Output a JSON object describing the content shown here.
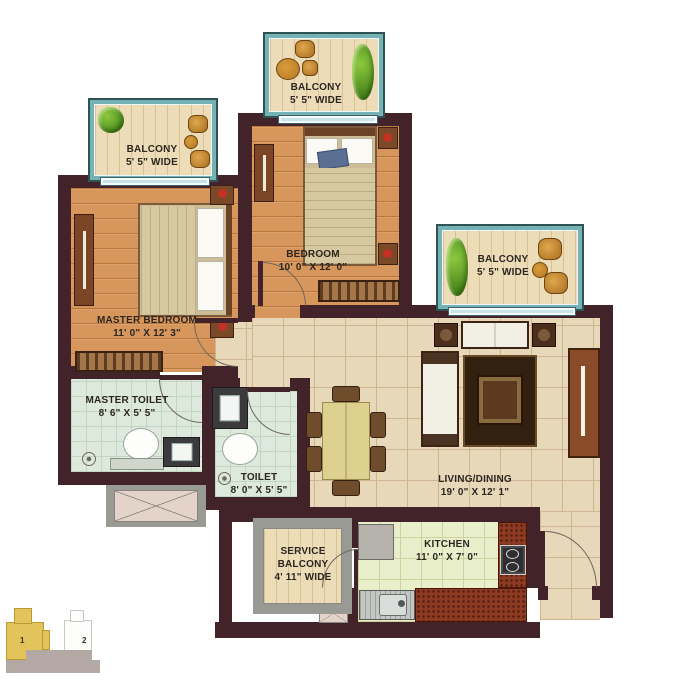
{
  "plan": {
    "master_bedroom": {
      "name": "MASTER BEDROOM",
      "dims": "11' 0\" X 12' 3\""
    },
    "bedroom": {
      "name": "BEDROOM",
      "dims": "10' 0\" X 12' 0\""
    },
    "living_dining": {
      "name": "LIVING/DINING",
      "dims": "19' 0\" X 12' 1\""
    },
    "master_toilet": {
      "name": "MASTER TOILET",
      "dims": "8' 6\" X 5' 5\""
    },
    "toilet": {
      "name": "TOILET",
      "dims": "8' 0\" X 5' 5\""
    },
    "kitchen": {
      "name": "KITCHEN",
      "dims": "11' 0\" X 7' 0\""
    },
    "service_balcony": {
      "name_line1": "SERVICE",
      "name_line2": "BALCONY",
      "dims": "4' 11\" WIDE"
    },
    "balcony_top_left": {
      "name": "BALCONY",
      "dims": "5' 5\" WIDE"
    },
    "balcony_top_center": {
      "name": "BALCONY",
      "dims": "5' 5\" WIDE"
    },
    "balcony_right": {
      "name": "BALCONY",
      "dims": "5' 5\" WIDE"
    }
  },
  "key_plan": {
    "unit_1_label": "1",
    "unit_2_label": "2"
  },
  "colors": {
    "wall": "#42232a",
    "balcony_frame": "#74b2b6",
    "bedroom_floor": "#d7975c",
    "living_floor": "#e7d8ba",
    "toilet_floor": "#dde9dd",
    "kitchen_floor": "#eaefcb",
    "counter_red": "#8c3a22",
    "key_unit_highlight": "#e3c35c"
  }
}
